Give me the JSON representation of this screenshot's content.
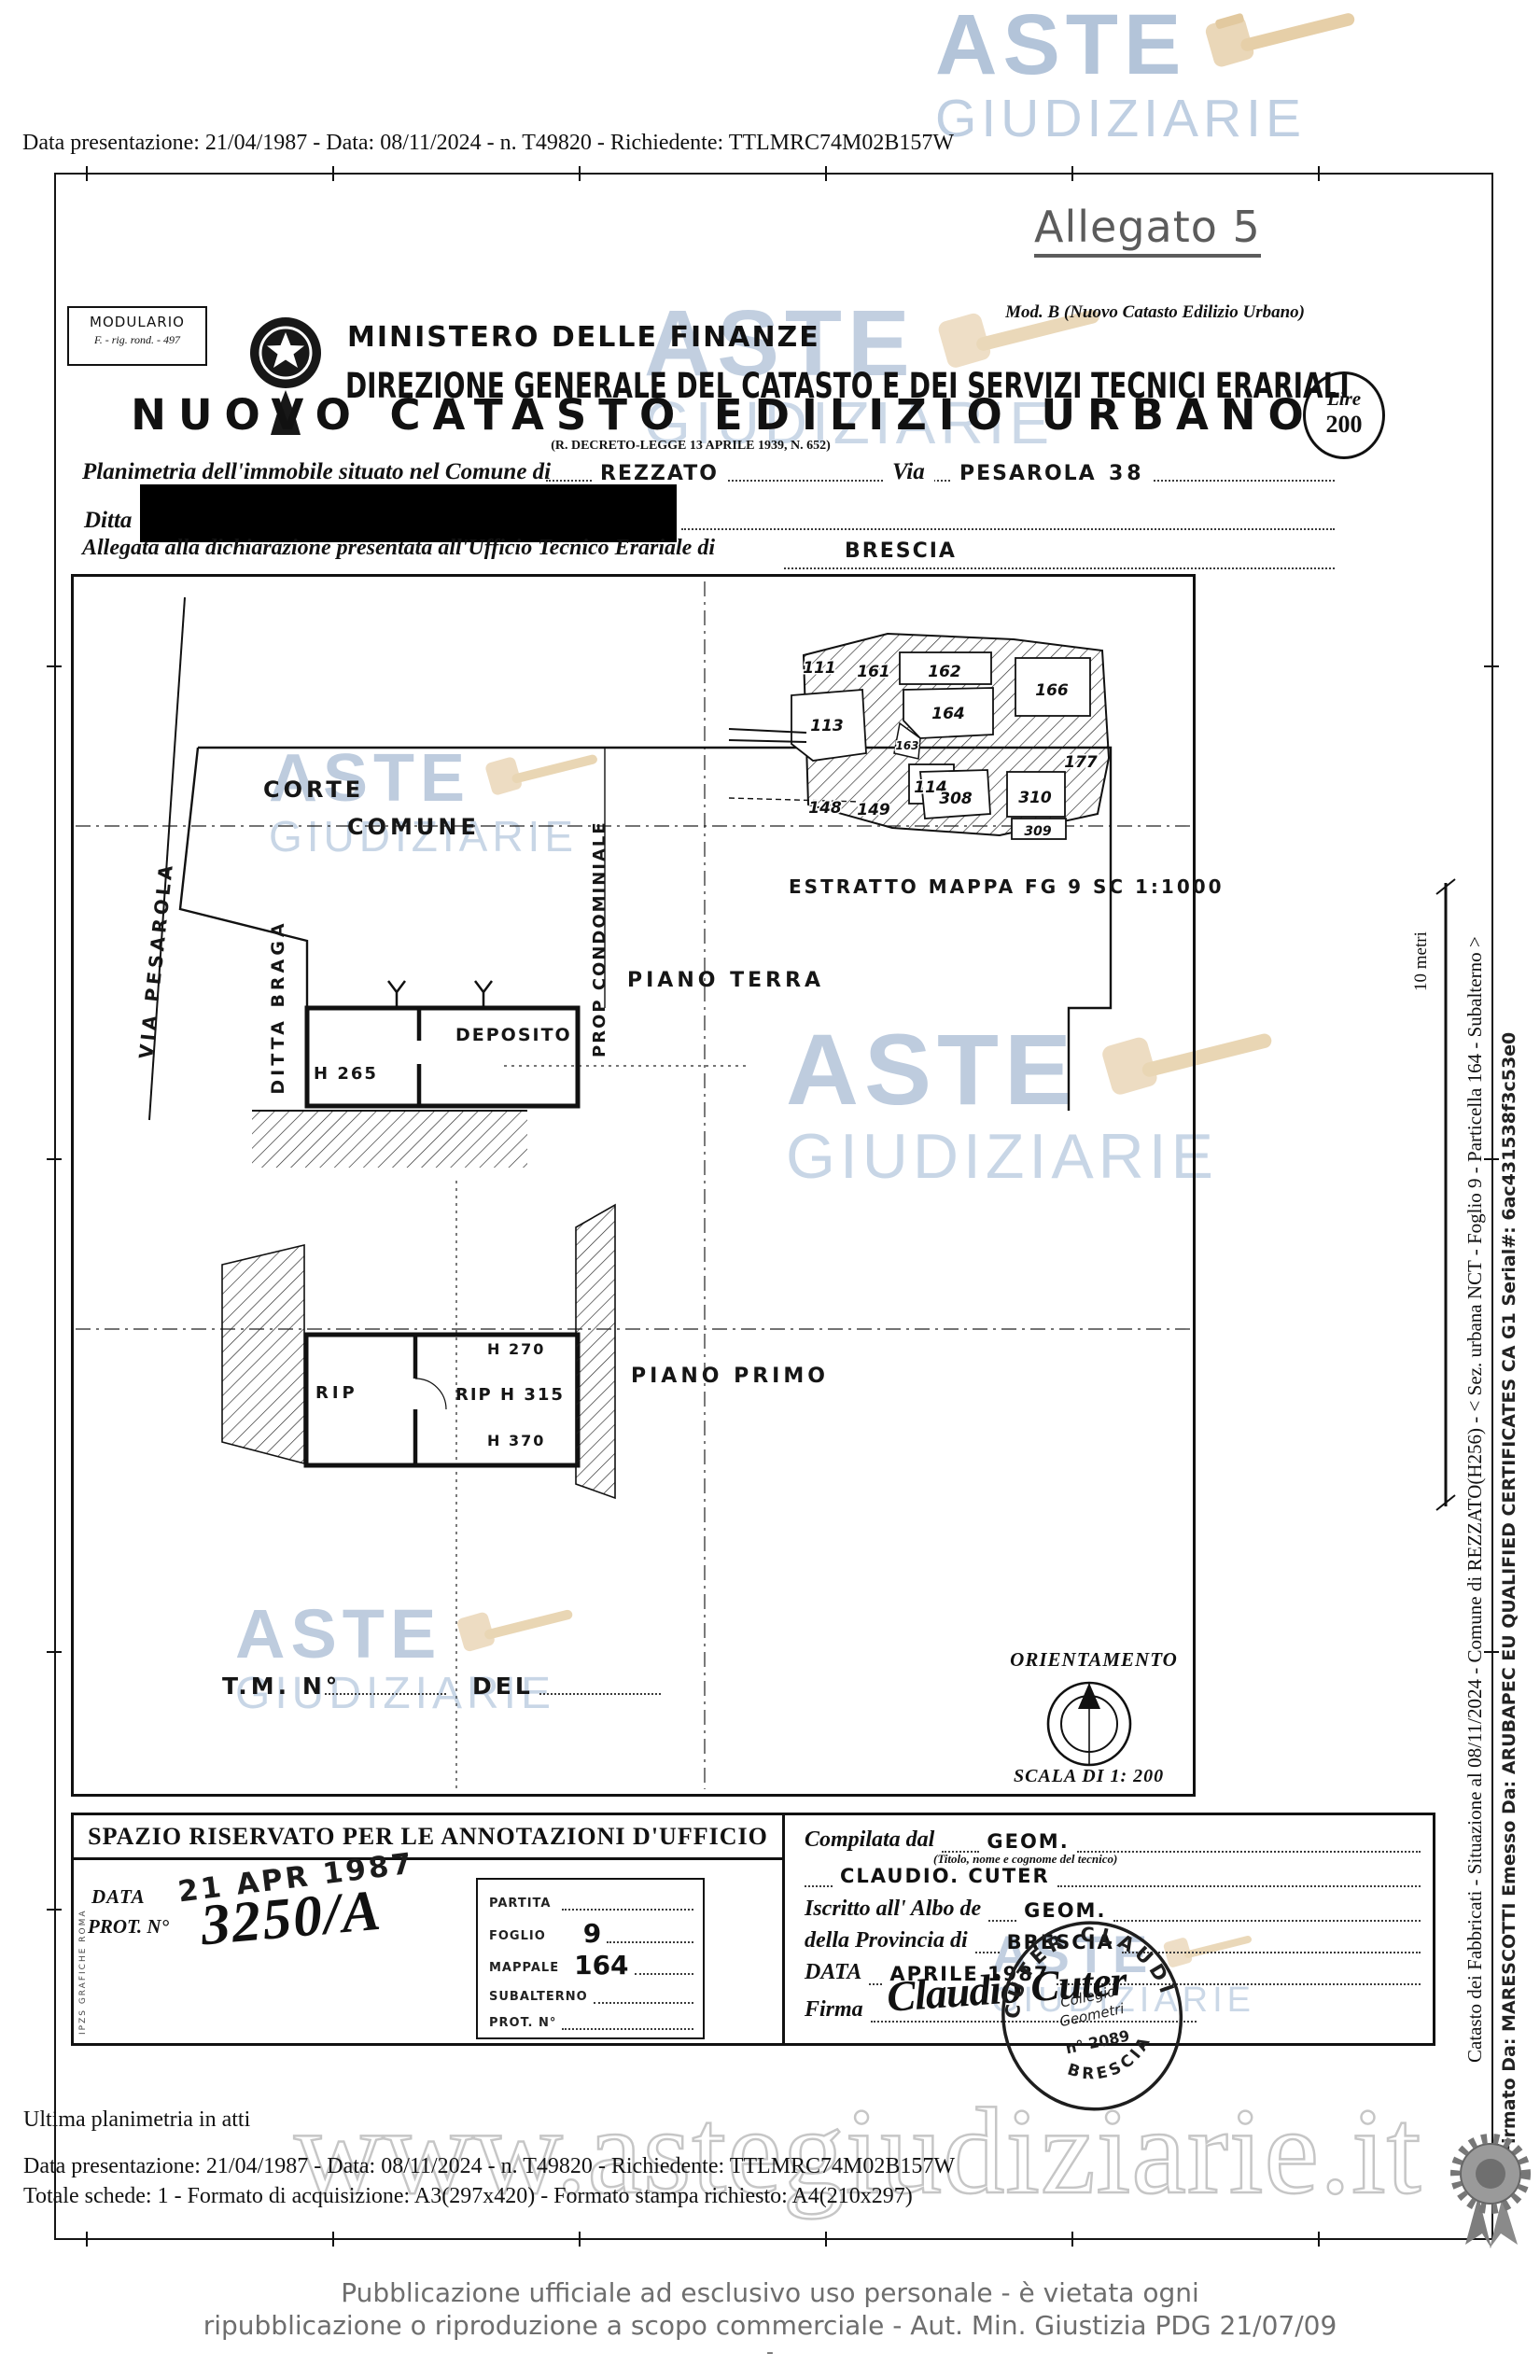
{
  "logo": {
    "aste": "ASTE",
    "giudiziarie": "GIUDIZIARIE"
  },
  "colors": {
    "watermark_blue": "#b3c4d9",
    "watermark_blue_light": "#bfcfe2",
    "gavel_tan": "#ead7b8",
    "gray_text": "#6e6e6e",
    "url_outline": "#c8c8c8"
  },
  "top": {
    "presentation": "Data presentazione: 21/04/1987 - Data: 08/11/2024 - n. T49820 - Richiedente: TTLMRC74M02B157W",
    "allegato": "Allegato 5"
  },
  "form": {
    "modulario1": "MODULARIO",
    "modulario2": "F. - rig. rond. - 497",
    "mod_b": "Mod. B (Nuovo Catasto Edilizio Urbano)",
    "ministero": "MINISTERO DELLE FINANZE",
    "direzione": "DIREZIONE GENERALE DEL CATASTO E DEI SERVIZI TECNICI ERARIALI",
    "lire": "Lire",
    "lire_value": "200",
    "titolo": "NUOVO CATASTO EDILIZIO URBANO",
    "decreto": "(R. DECRETO-LEGGE 13 APRILE 1939, N. 652)",
    "planimetria_label": "Planimetria dell'immobile situato nel Comune di",
    "comune": "REZZATO",
    "via_label": "Via",
    "via": "PESAROLA",
    "civico": "38",
    "ditta_label": "Ditta",
    "allegata_label": "Allegata alla dichiarazione presentata all'Ufficio Tecnico Erariale di",
    "ufficio": "BRESCIA"
  },
  "plan": {
    "corte": "CORTE",
    "comune": "COMUNE",
    "via_pesarola": "VIA PESAROLA",
    "ditta_braga": "DITTA BRAGA",
    "prop": "PROP CONDOMINIALE",
    "piano_terra": "PIANO TERRA",
    "deposito": "DEPOSITO",
    "h_265": "H 265",
    "piano_primo": "PIANO PRIMO",
    "rip": "RIP",
    "rip_h315": "RIP H 315",
    "h_270": "H 270",
    "h_370": "H 370",
    "map_caption": "ESTRATTO MAPPA FG 9 SC 1:1000",
    "map_parcels": [
      "111",
      "161",
      "113",
      "162",
      "164",
      "163",
      "166",
      "114",
      "148",
      "149",
      "308",
      "310",
      "309",
      "177"
    ],
    "tm": "T.M. N°",
    "del": "DEL",
    "orientamento": "ORIENTAMENTO",
    "scala": "SCALA DI 1: 200"
  },
  "annotazioni": {
    "header": "SPAZIO RISERVATO PER LE ANNOTAZIONI D'UFFICIO",
    "data_label": "DATA",
    "data_stamp": "21 APR 1987",
    "prot_label": "PROT. N°",
    "prot_value": "3250/A",
    "registry": [
      {
        "label": "PARTITA",
        "value": ""
      },
      {
        "label": "FOGLIO",
        "value": "9"
      },
      {
        "label": "MAPPALE",
        "value": "164"
      },
      {
        "label": "SUBALTERNO",
        "value": ""
      },
      {
        "label": "PROT. N°",
        "value": ""
      }
    ],
    "compilata_label": "Compilata dal",
    "compilata_value": "GEOM.",
    "titolo_note": "(Titolo, nome e cognome del tecnico)",
    "tecnico": "CLAUDIO. CUTER",
    "albo_label": "Iscritto all' Albo de",
    "albo_value": "GEOM.",
    "provincia_label": "della Provincia di",
    "provincia_value": "BRESCIA",
    "data2_label": "DATA",
    "data2_value": "APRILE 1987",
    "firma_label": "Firma",
    "firma_script": "Claudio Cuter",
    "stamp": {
      "arc_top": "CUTER CLAUDIO",
      "line1": "Collegio",
      "line2": "Geometri",
      "number": "n° 2089",
      "arc_bottom": "BRESCIA"
    }
  },
  "side": {
    "scale_label": "10 metri",
    "catasto_line": "Catasto dei Fabbricati - Situazione al 08/11/2024 - Comune di REZZATO(H256) - < Sez. urbana NCT - Foglio 9 - Particella 164 - Subalterno >",
    "firma_line": "Firmato Da: MARESCOTTI Emesso Da: ARUBAPEC EU QUALIFIED CERTIFICATES CA G1 Serial#: 6ac431538f3c53e0",
    "imprint": "IPZS GRAFICHE ROMA"
  },
  "footer": {
    "ultima": "Ultima planimetria in atti",
    "presentation": "Data presentazione: 21/04/1987 - Data: 08/11/2024 - n. T49820 - Richiedente: TTLMRC74M02B157W",
    "totale": "Totale schede: 1 - Formato di acquisizione: A3(297x420) - Formato stampa richiesto: A4(210x297)",
    "url_watermark": "www.astegiudiziarie.it",
    "pub1": "Pubblicazione ufficiale ad esclusivo uso personale - è vietata ogni",
    "pub2": "ripubblicazione o riproduzione a scopo commerciale - Aut. Min. Giustizia PDG 21/07/09",
    "dash": "-"
  }
}
